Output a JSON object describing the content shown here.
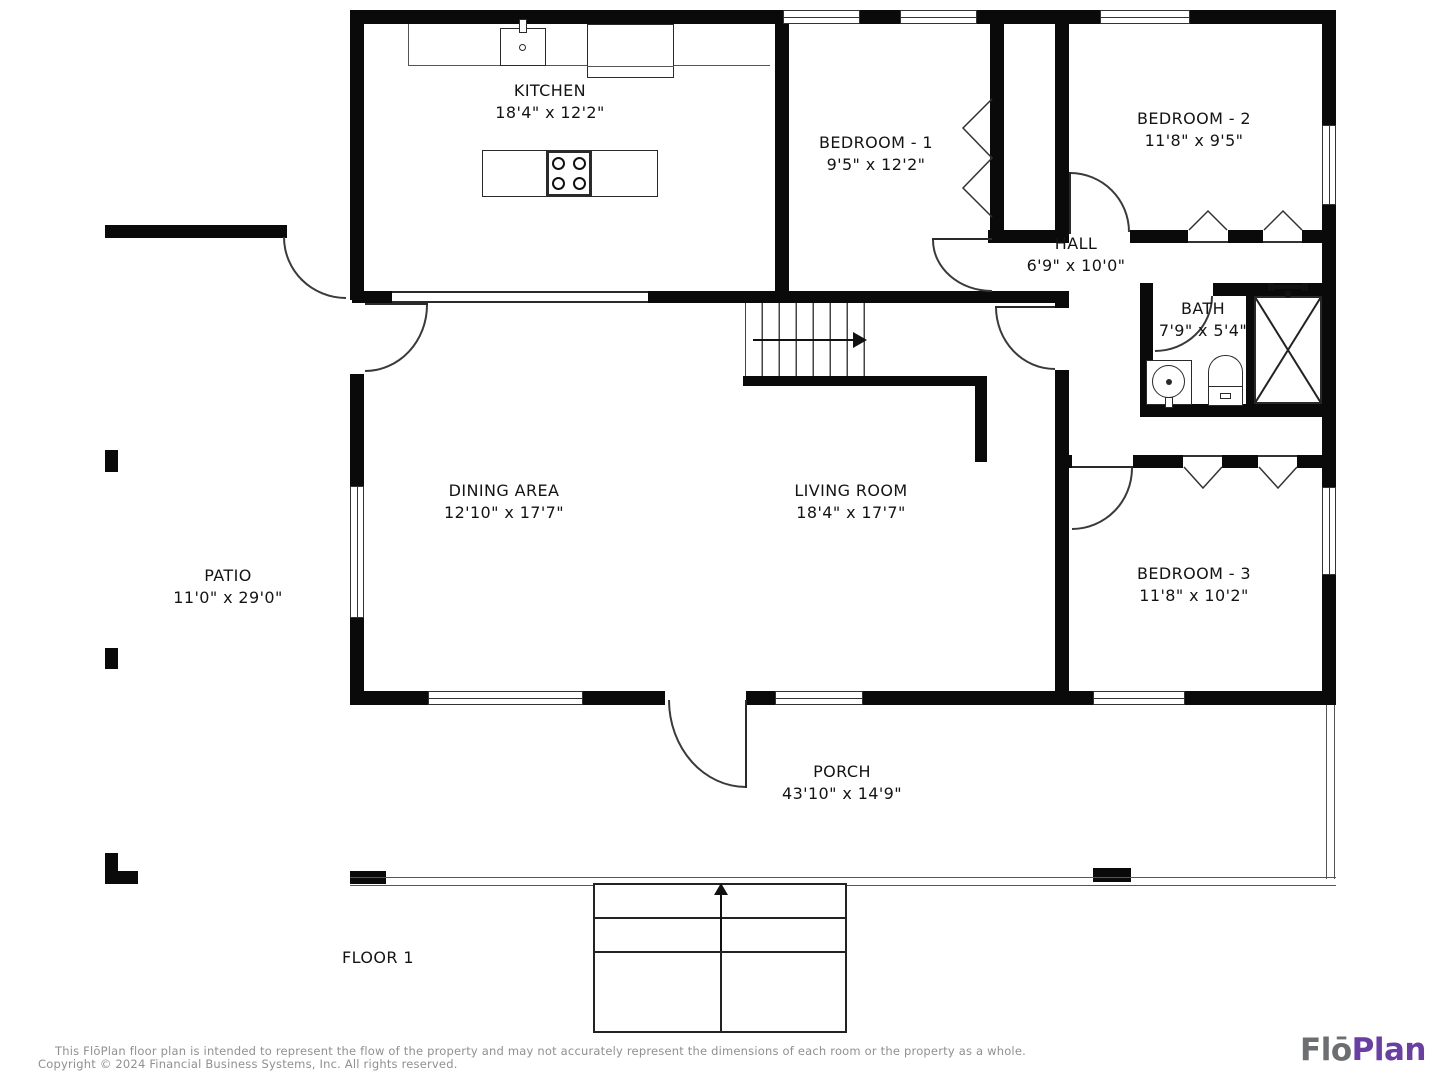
{
  "rooms": {
    "kitchen": {
      "name": "KITCHEN",
      "dims": "18'4\" x 12'2\""
    },
    "bedroom1": {
      "name": "BEDROOM - 1",
      "dims": "9'5\" x 12'2\""
    },
    "bedroom2": {
      "name": "BEDROOM - 2",
      "dims": "11'8\" x 9'5\""
    },
    "hall": {
      "name": "HALL",
      "dims": "6'9\" x 10'0\""
    },
    "bath": {
      "name": "BATH",
      "dims": "7'9\" x 5'4\""
    },
    "dining": {
      "name": "DINING AREA",
      "dims": "12'10\" x 17'7\""
    },
    "living": {
      "name": "LIVING ROOM",
      "dims": "18'4\" x 17'7\""
    },
    "bedroom3": {
      "name": "BEDROOM - 3",
      "dims": "11'8\" x 10'2\""
    },
    "patio": {
      "name": "PATIO",
      "dims": "11'0\" x 29'0\""
    },
    "porch": {
      "name": "PORCH",
      "dims": "43'10\" x 14'9\""
    }
  },
  "floor_label": "FLOOR 1",
  "footer": {
    "disclaimer": "This FlōPlan floor plan is intended to represent the flow of the property and may not accurately represent the dimensions of each room or the property as a whole.",
    "copyright": "Copyright © 2024 Financial Business Systems, Inc. All rights reserved."
  },
  "logo": {
    "part1": "Flō",
    "part2": "Plan",
    "part1_color": "#6d6e71",
    "part2_color": "#6a3fa3"
  },
  "colors": {
    "wall": "#0a0a0a",
    "line": "#333333",
    "footer_text": "#8f9093"
  },
  "icons": {
    "stairs_arrow": "stairs-up-direction",
    "entry_arrow": "porch-entry-direction"
  }
}
